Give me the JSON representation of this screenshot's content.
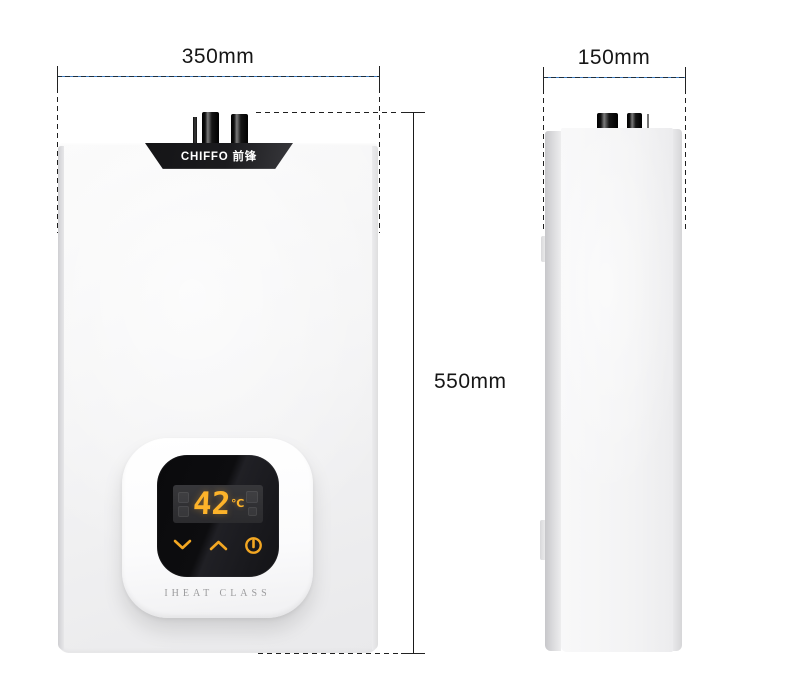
{
  "diagram": {
    "width_label": "350mm",
    "depth_label": "150mm",
    "height_label": "550mm"
  },
  "heater": {
    "brand": "CHIFFO 前锋",
    "display_temperature": "42",
    "display_unit": "℃",
    "series_caption": "IHEAT CLASS",
    "controls": {
      "down_icon": "chevron-down",
      "up_icon": "chevron-up",
      "power_icon": "power"
    }
  },
  "colors": {
    "accent_amber": "#FDB32A",
    "panel_black": "#0D0D0F",
    "body_white": "#F3F3F4",
    "dimension_line_blue": "#3F7CC0",
    "dimension_line_dark": "#1D2F3F",
    "label_text": "#161616"
  }
}
